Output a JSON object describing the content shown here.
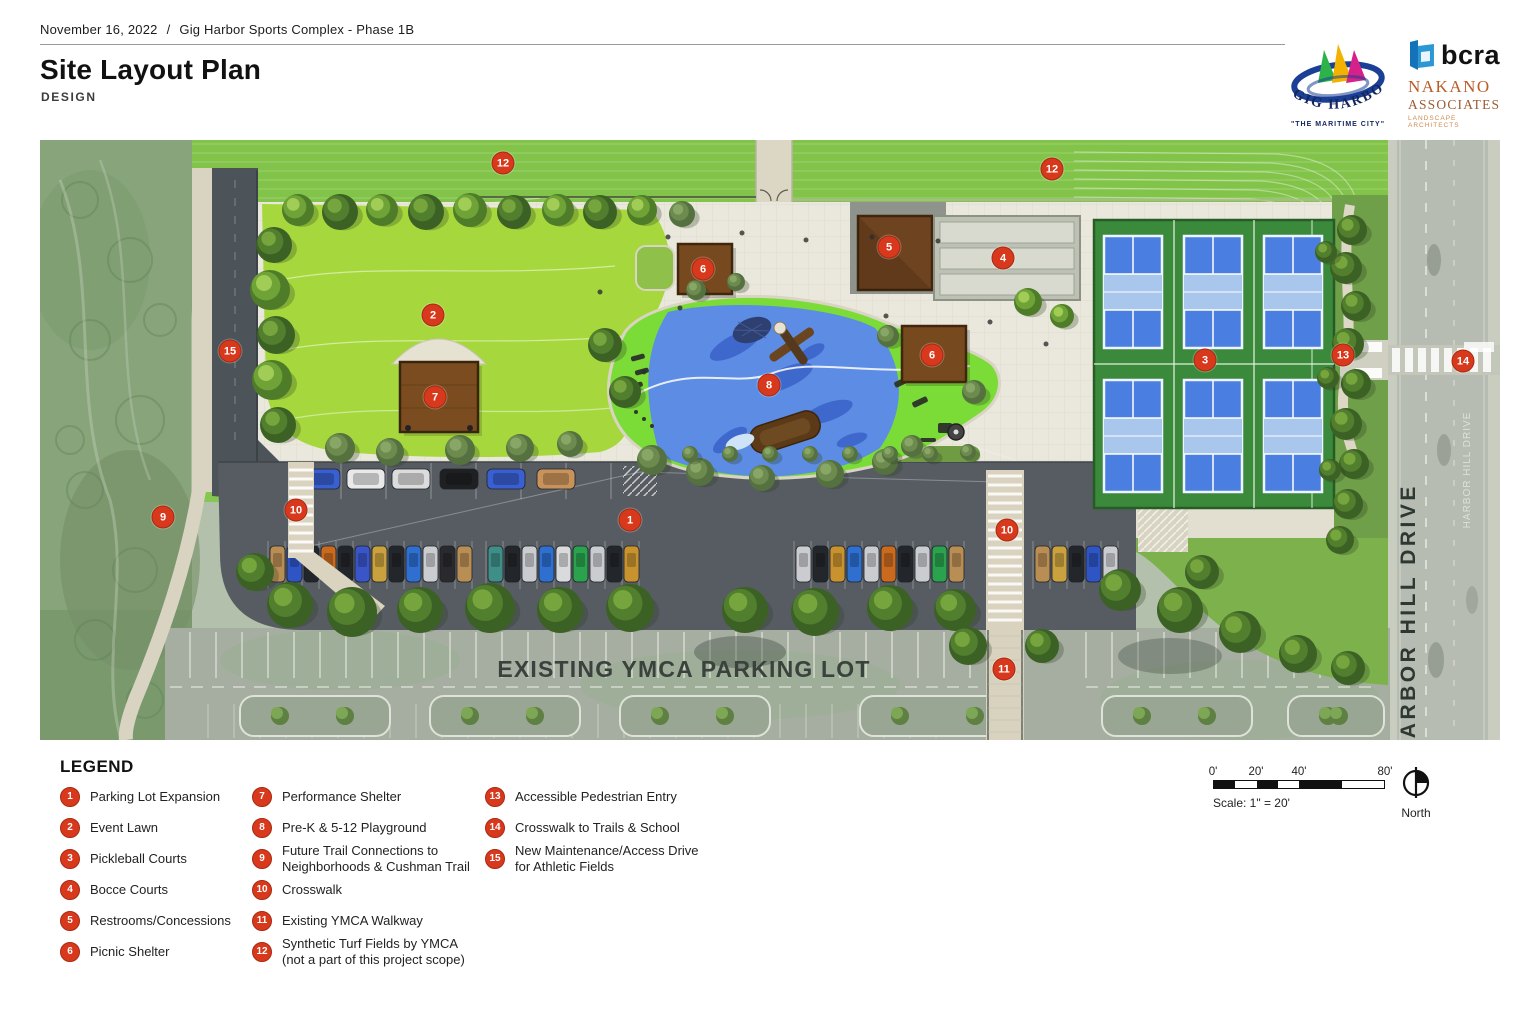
{
  "header": {
    "date": "November 16, 2022",
    "divider": "/",
    "project": "Gig Harbor Sports Complex - Phase 1B",
    "title": "Site Layout Plan",
    "subtitle": "DESIGN"
  },
  "logos": {
    "gig_harbor": {
      "name": "GIG HARBOR",
      "tagline": "\"THE MARITIME CITY\""
    },
    "bcra": {
      "name": "bcra"
    },
    "nakano": {
      "name": "NAKANO",
      "name2": "ASSOCIATES",
      "tagline": "LANDSCAPE ARCHITECTS"
    }
  },
  "map": {
    "labels": {
      "ymca_lot": "EXISTING YMCA PARKING LOT",
      "road": "HARBOR HILL DRIVE"
    },
    "markers": [
      {
        "num": "12",
        "x": 463,
        "y": 23,
        "name": "synthetic-turf-fields-west"
      },
      {
        "num": "12",
        "x": 1012,
        "y": 29,
        "name": "synthetic-turf-fields-east"
      },
      {
        "num": "5",
        "x": 849,
        "y": 107,
        "name": "restrooms-concessions"
      },
      {
        "num": "4",
        "x": 963,
        "y": 118,
        "name": "bocce-courts"
      },
      {
        "num": "6",
        "x": 663,
        "y": 129,
        "name": "picnic-shelter-north"
      },
      {
        "num": "2",
        "x": 393,
        "y": 175,
        "name": "event-lawn"
      },
      {
        "num": "15",
        "x": 190,
        "y": 211,
        "name": "maintenance-access-drive"
      },
      {
        "num": "6",
        "x": 892,
        "y": 215,
        "name": "picnic-shelter-east"
      },
      {
        "num": "3",
        "x": 1165,
        "y": 220,
        "name": "pickleball-courts"
      },
      {
        "num": "13",
        "x": 1303,
        "y": 215,
        "name": "accessible-pedestrian-entry"
      },
      {
        "num": "14",
        "x": 1423,
        "y": 221,
        "name": "crosswalk-trails-school"
      },
      {
        "num": "8",
        "x": 729,
        "y": 245,
        "name": "playground"
      },
      {
        "num": "7",
        "x": 395,
        "y": 257,
        "name": "performance-shelter"
      },
      {
        "num": "10",
        "x": 256,
        "y": 370,
        "name": "crosswalk-west"
      },
      {
        "num": "9",
        "x": 123,
        "y": 377,
        "name": "future-trail-connections"
      },
      {
        "num": "1",
        "x": 590,
        "y": 380,
        "name": "parking-lot-expansion"
      },
      {
        "num": "10",
        "x": 967,
        "y": 390,
        "name": "crosswalk-east"
      },
      {
        "num": "11",
        "x": 964,
        "y": 529,
        "name": "existing-ymca-walkway"
      }
    ]
  },
  "legend": {
    "title": "LEGEND",
    "columns": [
      6,
      6,
      3
    ],
    "items": [
      {
        "num": "1",
        "lines": [
          "Parking Lot Expansion"
        ]
      },
      {
        "num": "2",
        "lines": [
          "Event Lawn"
        ]
      },
      {
        "num": "3",
        "lines": [
          "Pickleball Courts"
        ]
      },
      {
        "num": "4",
        "lines": [
          "Bocce Courts"
        ]
      },
      {
        "num": "5",
        "lines": [
          "Restrooms/Concessions"
        ]
      },
      {
        "num": "6",
        "lines": [
          "Picnic Shelter"
        ]
      },
      {
        "num": "7",
        "lines": [
          "Performance Shelter"
        ]
      },
      {
        "num": "8",
        "lines": [
          "Pre-K & 5-12 Playground"
        ]
      },
      {
        "num": "9",
        "lines": [
          "Future Trail Connections to",
          "Neighborhoods & Cushman Trail"
        ]
      },
      {
        "num": "10",
        "lines": [
          "Crosswalk"
        ]
      },
      {
        "num": "11",
        "lines": [
          "Existing YMCA Walkway"
        ]
      },
      {
        "num": "12",
        "lines": [
          "Synthetic Turf Fields by YMCA",
          "(not a part of this project scope)"
        ]
      },
      {
        "num": "13",
        "lines": [
          "Accessible Pedestrian Entry"
        ]
      },
      {
        "num": "14",
        "lines": [
          "Crosswalk to Trails & School"
        ]
      },
      {
        "num": "15",
        "lines": [
          "New Maintenance/Access Drive",
          "for Athletic Fields"
        ]
      }
    ]
  },
  "scalebar": {
    "ticks": [
      "0'",
      "20'",
      "40'",
      "80'"
    ],
    "label": "Scale: 1\" = 20'",
    "north": "North"
  },
  "colors": {
    "marker_red": "#d8391d",
    "turf_green": "#82c44a",
    "lawn_green": "#a6d83e",
    "court_green": "#3b8a3b",
    "court_blue": "#4a7ee0",
    "court_kitchen": "#a9c6ec",
    "playground_blue": "#5c8ce4",
    "playground_lime": "#7bdc38",
    "asphalt": "#565c62",
    "paving": "#eae8dc",
    "shelter_brown": "#6e431f"
  }
}
